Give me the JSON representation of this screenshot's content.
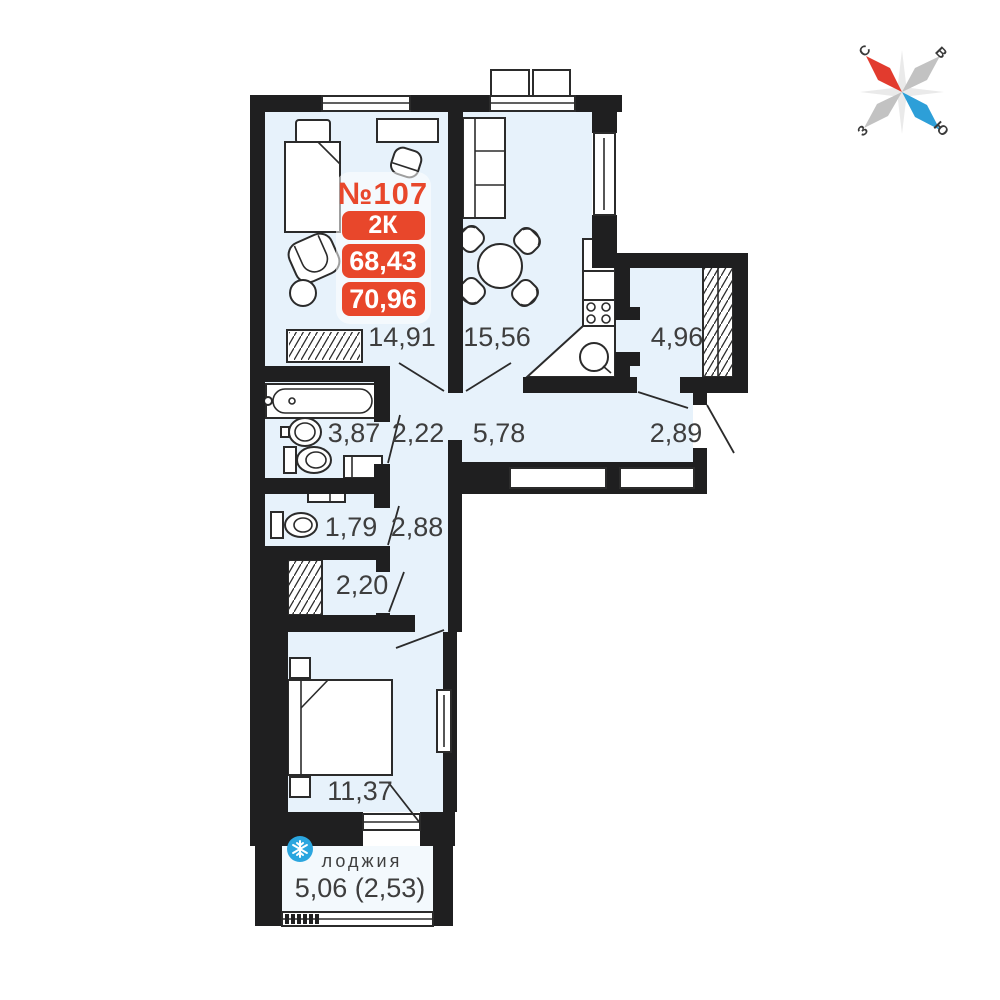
{
  "plan": {
    "apartment_number": "№107",
    "badges": {
      "rooms": "2К",
      "area_living": "68,43",
      "area_total": "70,96"
    },
    "rooms": [
      {
        "id": "living-room",
        "area": "14,91"
      },
      {
        "id": "kitchen",
        "area": "15,56"
      },
      {
        "id": "dressing",
        "area": "4,96"
      },
      {
        "id": "bathroom",
        "area": "3,87"
      },
      {
        "id": "hall-small",
        "area": "2,22"
      },
      {
        "id": "corridor",
        "area": "5,78"
      },
      {
        "id": "entry-hall",
        "area": "2,89"
      },
      {
        "id": "wc",
        "area": "1,79"
      },
      {
        "id": "hall",
        "area": "2,88"
      },
      {
        "id": "closet",
        "area": "2,20"
      },
      {
        "id": "bedroom",
        "area": "11,37"
      }
    ],
    "loggia": {
      "label": "лоджия",
      "area": "5,06 (2,53)"
    },
    "compass": {
      "north": "С",
      "east": "В",
      "west": "З",
      "south": "Ю"
    },
    "colors": {
      "wall": "#1f1f20",
      "room_fill": "#e7f2fb",
      "accent_red": "#e8472b",
      "loggia_badge_blue": "#2ba6df",
      "compass_red": "#e23b2e",
      "compass_blue": "#2d9fd8",
      "label_text": "#3e3e3e"
    }
  }
}
